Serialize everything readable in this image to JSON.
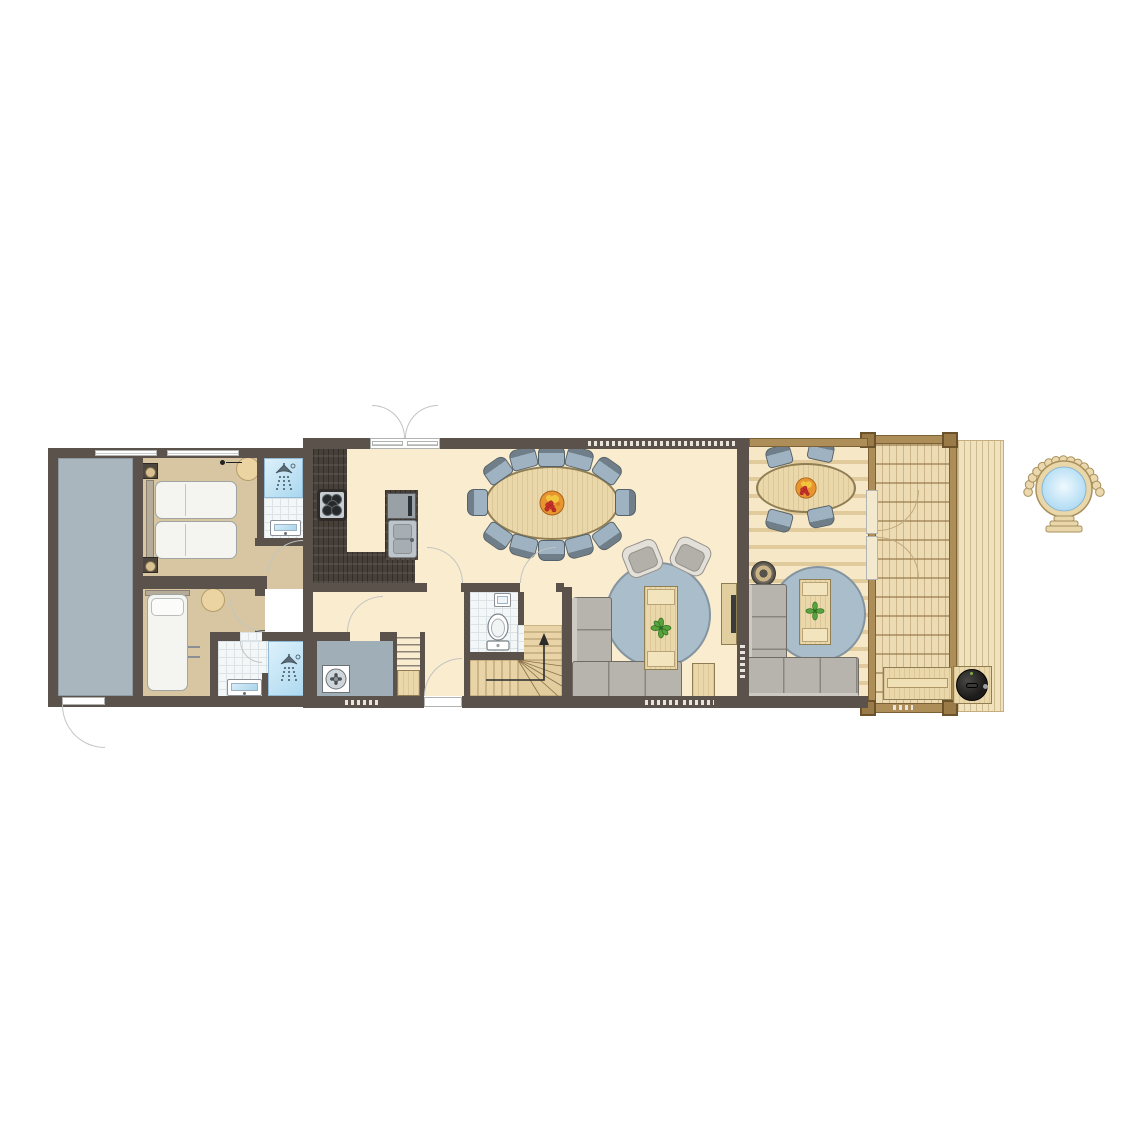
{
  "figure": {
    "type": "floor-plan",
    "floor": "ground-floor"
  },
  "palette": {
    "wall": "#5A524B",
    "floor_cream": "#FAECCE",
    "floor_tan": "#D7C6A1",
    "shed": "#A9B6BD",
    "tech": "#A0AEB7",
    "tile": "#F4F7F8",
    "tile_line": "#DCE3E7",
    "shower_from": "#DDF1FB",
    "shower_to": "#A9D7EF",
    "counter": "#474039",
    "wood": "#EAD8AA",
    "wood_line": "#8F7E53",
    "deck": "#F6E8C6",
    "deck_stripe": "#E1CA9C",
    "outdeck": "#EDDBB3",
    "beam": "#AD8D58",
    "beam_dark": "#7C6136",
    "rug": "#AABDCA",
    "rug_line": "#8495A1",
    "sofa": "#B7B4AD",
    "sofa_line": "#6E6A64",
    "chair": "#9EB2C1",
    "chair_dark": "#6F7E88",
    "chair_line": "#55626C",
    "stool": "#EBD3A2",
    "stool_line": "#B59D6B",
    "stairs": "#E8D4A6",
    "stair_line": "#AE9468",
    "water": "#BFE3F7",
    "green": "#57A43D",
    "fruit_orange": "#E8952F",
    "fruit_red": "#C92F2B",
    "fruit_yellow": "#F2C53D",
    "door_line": "#C2C5C1",
    "dash": "#E9E5DD",
    "black": "#1D1C1A"
  },
  "icons": {
    "shower": "shower-head-with-spray",
    "toilet": "toilet-top-view",
    "washbasin": "rectangular-basin",
    "stove": "five-burner-hob",
    "kitchen_sink": "double-basin-sink",
    "oven": "built-in-oven",
    "ventilation": "fan-unit",
    "stairs_arrow": "up-arrow",
    "fruit_bowl": "fruit-bowl",
    "plant": "potted-plant",
    "fire_bowl": "fire-bowl",
    "bbq": "kamado-grill",
    "hot_tub": "wood-fired-hot-tub",
    "bed_double": "double-bed",
    "bed_single": "single-bed",
    "sofa": "corner-sofa",
    "armchair": "armchair",
    "dining_table": "oval-dining-table-12-seats",
    "terrace_table": "oval-table-4-seats",
    "tv": "tv-on-cabinet",
    "bench": "garden-bench"
  }
}
